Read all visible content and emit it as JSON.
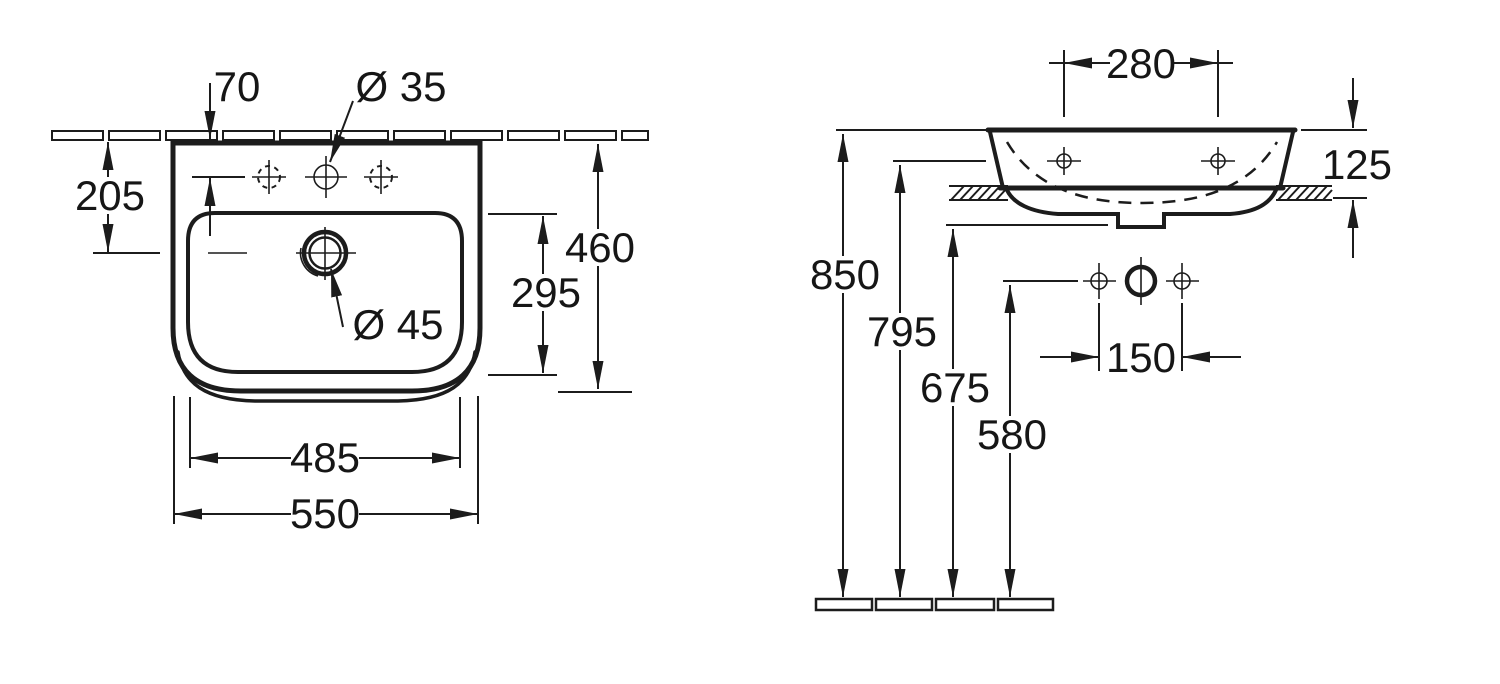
{
  "plan_view": {
    "tap_hole_offset": "70",
    "tap_hole_diameter": "Ø 35",
    "drain_offset": "205",
    "inner_depth": "295",
    "overall_depth": "460",
    "drain_diameter": "Ø 45",
    "inner_width": "485",
    "overall_width": "550"
  },
  "side_view": {
    "fixing_hole_spacing": "280",
    "body_height": "125",
    "rim_height": "850",
    "fixing_hole_height": "795",
    "underside_height": "675",
    "connection_height": "580",
    "connection_spacing": "150"
  },
  "colors": {
    "line": "#1c1c1c",
    "background": "#ffffff"
  }
}
